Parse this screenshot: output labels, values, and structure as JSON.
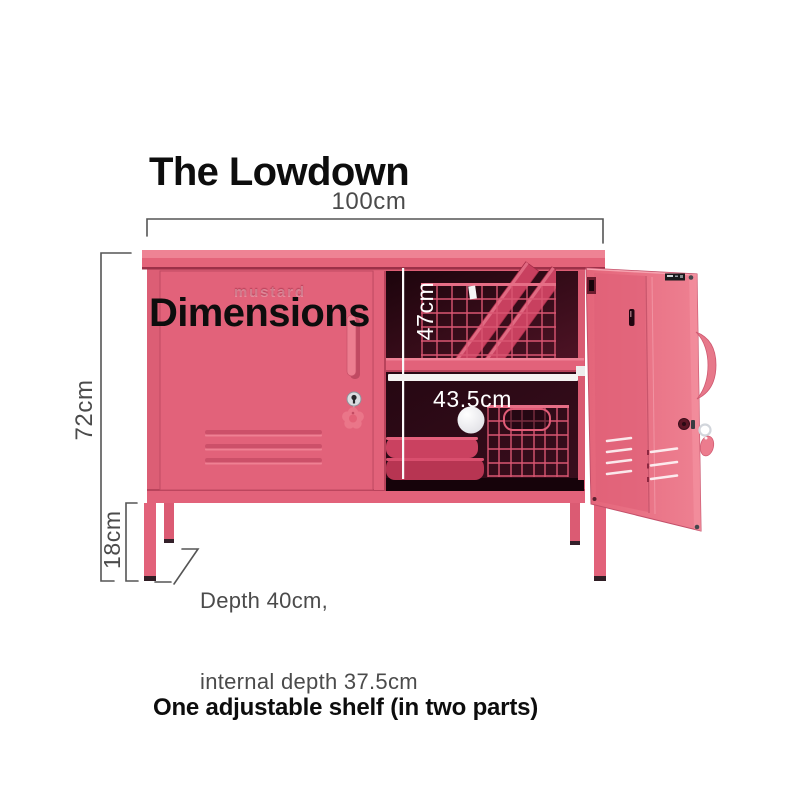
{
  "title": {
    "line1": "The Lowdown",
    "line2": "Dimensions"
  },
  "brand": {
    "logo": "mustard"
  },
  "dimensions": {
    "width": "100cm",
    "height": "72cm",
    "leg_height": "18cm",
    "internal_height": "47cm",
    "internal_width": "43.5cm",
    "depth_note_line1": "Depth 40cm,",
    "depth_note_line2": "internal depth 37.5cm"
  },
  "note": "One adjustable shelf (in two parts)",
  "colors": {
    "locker_pink": "#e2627a",
    "locker_pink_light": "#ee8394",
    "locker_pink_dark": "#c04a62",
    "interior_dark": "#2a0712",
    "basket_pink": "#d95672",
    "dimension_gray": "#4b4b4b",
    "dimension_white": "#ffffff",
    "text_black": "#0d0d0d",
    "background": "#ffffff"
  }
}
